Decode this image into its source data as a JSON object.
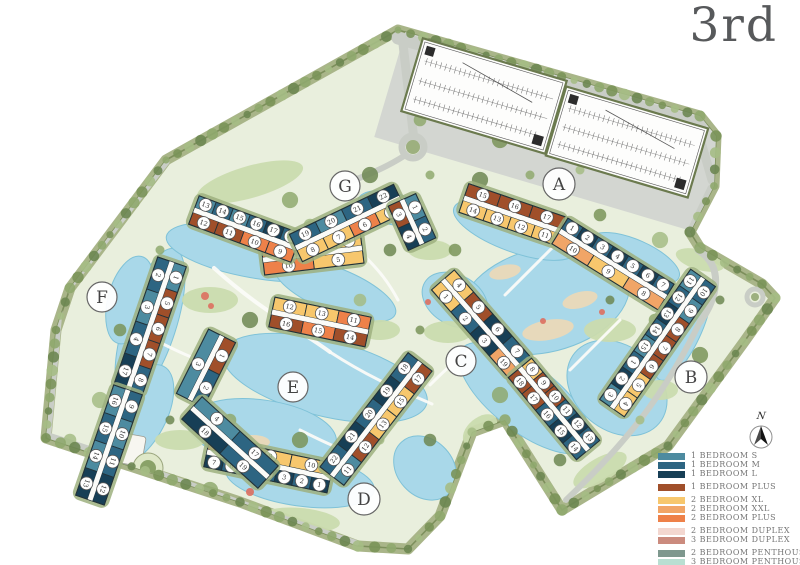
{
  "title": "3rd",
  "compass": {
    "north_label": "N"
  },
  "palette": {
    "s1": "#4d8ba0",
    "m1": "#2d6582",
    "l1": "#173f56",
    "p1": "#a04f2a",
    "xl2": "#f7c76d",
    "xxl2": "#f1a567",
    "p2": "#ee8149",
    "d2": "#f3d7d0",
    "d3": "#cb8b7e",
    "ph2": "#7e988e",
    "ph3": "#b9dfd2"
  },
  "legend": {
    "groups": [
      {
        "items": [
          {
            "label": "1 BEDROOM S",
            "color": "s1"
          },
          {
            "label": "1 BEDROOM M",
            "color": "m1"
          },
          {
            "label": "1 BEDROOM L",
            "color": "l1"
          }
        ]
      },
      {
        "items": [
          {
            "label": "1 BEDROOM PLUS",
            "color": "p1"
          }
        ]
      },
      {
        "items": [
          {
            "label": "2 BEDROOM XL",
            "color": "xl2"
          },
          {
            "label": "2 BEDROOM XXL",
            "color": "xxl2"
          },
          {
            "label": "2 BEDROOM PLUS",
            "color": "p2"
          }
        ]
      },
      {
        "items": [
          {
            "label": "2 BEDROOM DUPLEX",
            "color": "d2"
          },
          {
            "label": "3 BEDROOM DUPLEX",
            "color": "d3"
          }
        ]
      },
      {
        "items": [
          {
            "label": "2 BEDROOM PENTHOUSE",
            "color": "ph2"
          },
          {
            "label": "3 BEDROOM PENTHOUSE",
            "color": "ph3"
          }
        ]
      }
    ]
  },
  "buildings": [
    {
      "id": "A",
      "label": "A",
      "lx": 559,
      "ly": 184,
      "r": 16,
      "segments": [
        {
          "x1": 464,
          "y1": 198,
          "x2": 560,
          "y2": 231,
          "rows": [
            [
              {
                "n": 15,
                "c": "p1"
              },
              {
                "n": 16,
                "c": "p1"
              },
              {
                "n": 17,
                "c": "p1"
              }
            ],
            [
              {
                "n": 14,
                "c": "xl2"
              },
              {
                "n": 13,
                "c": "xl2"
              },
              {
                "n": 12,
                "c": "xl2"
              },
              {
                "n": 11,
                "c": "xl2"
              }
            ]
          ]
        },
        {
          "x1": 560,
          "y1": 231,
          "x2": 666,
          "y2": 297,
          "rows": [
            [
              {
                "n": 1,
                "c": "m1"
              },
              {
                "n": 2,
                "c": "l1"
              },
              {
                "n": 3,
                "c": "m1"
              },
              {
                "n": 4,
                "c": "l1"
              },
              {
                "n": 5,
                "c": "m1"
              },
              {
                "n": 6,
                "c": "l1"
              },
              {
                "n": 7,
                "c": "m1"
              }
            ],
            [
              {
                "n": 10,
                "c": "xxl2"
              },
              {
                "n": 9,
                "c": "xl2"
              },
              {
                "n": 8,
                "c": "xxl2"
              }
            ]
          ]
        }
      ]
    },
    {
      "id": "B",
      "label": "B",
      "lx": 691,
      "ly": 377,
      "r": 16,
      "segments": [
        {
          "x1": 703,
          "y1": 278,
          "x2": 612,
          "y2": 408,
          "rows": [
            [
              {
                "n": 10,
                "c": "m1"
              },
              {
                "n": 9,
                "c": "s1"
              },
              {
                "n": 8,
                "c": "p1"
              },
              {
                "n": 7,
                "c": "p1"
              },
              {
                "n": 6,
                "c": "p1"
              },
              {
                "n": 5,
                "c": "xl2"
              },
              {
                "n": 4,
                "c": "xl2"
              }
            ],
            [
              {
                "n": 11,
                "c": "s1"
              },
              {
                "n": 12,
                "c": "m1"
              },
              {
                "n": 13,
                "c": "l1"
              },
              {
                "n": 14,
                "c": "m1"
              },
              {
                "n": 15,
                "c": "s1"
              },
              {
                "n": 1,
                "c": "m1"
              },
              {
                "n": 2,
                "c": "l1"
              },
              {
                "n": 3,
                "c": "s1"
              }
            ]
          ]
        }
      ]
    },
    {
      "id": "C",
      "label": "C",
      "lx": 461,
      "ly": 361,
      "r": 15,
      "segments": [
        {
          "x1": 443,
          "y1": 280,
          "x2": 520,
          "y2": 368,
          "rows": [
            [
              {
                "n": 4,
                "c": "xl2"
              },
              {
                "n": 5,
                "c": "p1"
              },
              {
                "n": 6,
                "c": "l1"
              },
              {
                "n": 7,
                "c": "m1"
              }
            ],
            [
              {
                "n": 1,
                "c": "xl2"
              },
              {
                "n": 2,
                "c": "m1"
              },
              {
                "n": 3,
                "c": "l1"
              },
              {
                "n": 19,
                "c": "xxl2"
              }
            ]
          ]
        },
        {
          "x1": 520,
          "y1": 368,
          "x2": 588,
          "y2": 450,
          "rows": [
            [
              {
                "n": 8,
                "c": "xl2"
              },
              {
                "n": 9,
                "c": "p1"
              },
              {
                "n": 10,
                "c": "p1"
              },
              {
                "n": 11,
                "c": "m1"
              },
              {
                "n": 12,
                "c": "l1"
              },
              {
                "n": 13,
                "c": "m1"
              }
            ],
            [
              {
                "n": 18,
                "c": "p1"
              },
              {
                "n": 17,
                "c": "p1"
              },
              {
                "n": 16,
                "c": "m1"
              },
              {
                "n": 15,
                "c": "l1"
              },
              {
                "n": 14,
                "c": "m1"
              }
            ]
          ]
        }
      ]
    },
    {
      "id": "D",
      "label": "D",
      "lx": 364,
      "ly": 499,
      "r": 16,
      "segments": [
        {
          "x1": 207,
          "y1": 452,
          "x2": 330,
          "y2": 478,
          "rows": [
            [
              {
                "n": 8,
                "c": "p2"
              },
              {
                "n": 9,
                "c": "xl2"
              },
              {
                "n": 10,
                "c": "xl2"
              }
            ],
            [
              {
                "n": 7,
                "c": "l1"
              },
              {
                "n": 6,
                "c": "m1"
              },
              {
                "n": 5,
                "c": "l1"
              },
              {
                "n": 4,
                "c": "m1"
              },
              {
                "n": 3,
                "c": "l1"
              },
              {
                "n": 2,
                "c": "m1"
              },
              {
                "n": 1,
                "c": "l1"
              }
            ]
          ]
        },
        {
          "x1": 332,
          "y1": 476,
          "x2": 420,
          "y2": 362,
          "rows": [
            [
              {
                "n": 22,
                "c": "m1"
              },
              {
                "n": 21,
                "c": "l1"
              },
              {
                "n": 20,
                "c": "m1"
              },
              {
                "n": 19,
                "c": "l1"
              },
              {
                "n": 18,
                "c": "m1"
              }
            ],
            [
              {
                "n": 11,
                "c": "s1"
              },
              {
                "n": 12,
                "c": "p1"
              },
              {
                "n": 13,
                "c": "xl2"
              },
              {
                "n": 15,
                "c": "xl2"
              },
              {
                "n": 17,
                "c": "p1"
              }
            ]
          ]
        }
      ]
    },
    {
      "id": "E",
      "label": "E",
      "lx": 293,
      "ly": 387,
      "r": 15,
      "segments": [
        {
          "x1": 263,
          "y1": 260,
          "x2": 362,
          "y2": 248,
          "rows": [
            [
              {
                "n": 9,
                "c": "p2"
              },
              {
                "n": 8,
                "c": "p2"
              },
              {
                "n": 7,
                "c": "xxl2"
              },
              {
                "n": 6,
                "c": "xl2"
              }
            ],
            [
              {
                "n": 10,
                "c": "p2"
              },
              {
                "n": 5,
                "c": "xl2"
              }
            ]
          ]
        },
        {
          "x1": 272,
          "y1": 312,
          "x2": 368,
          "y2": 332,
          "rows": [
            [
              {
                "n": 12,
                "c": "xl2"
              },
              {
                "n": 13,
                "c": "xl2"
              },
              {
                "n": 11,
                "c": "p2"
              }
            ],
            [
              {
                "n": 16,
                "c": "p1"
              },
              {
                "n": 15,
                "c": "p2"
              },
              {
                "n": 14,
                "c": "p1"
              }
            ]
          ]
        },
        {
          "x1": 222,
          "y1": 336,
          "x2": 190,
          "y2": 400,
          "rows": [
            [
              {
                "n": 1,
                "c": "p1"
              },
              {
                "n": 2,
                "c": "m1"
              }
            ],
            [
              {
                "n": 3,
                "c": "s1"
              }
            ]
          ]
        },
        {
          "x1": 192,
          "y1": 408,
          "x2": 268,
          "y2": 477,
          "rows": [
            [
              {
                "n": 4,
                "c": "s1"
              },
              {
                "n": 17,
                "c": "m1"
              }
            ],
            [
              {
                "n": 18,
                "c": "l1"
              },
              {
                "n": 19,
                "c": "m1"
              }
            ]
          ]
        }
      ]
    },
    {
      "id": "F",
      "label": "F",
      "lx": 102,
      "ly": 297,
      "r": 15,
      "segments": [
        {
          "x1": 172,
          "y1": 262,
          "x2": 128,
          "y2": 390,
          "rows": [
            [
              {
                "n": 1,
                "c": "s1"
              },
              {
                "n": 5,
                "c": "p1"
              },
              {
                "n": 6,
                "c": "p1"
              },
              {
                "n": 7,
                "c": "p1"
              },
              {
                "n": 8,
                "c": "m1"
              }
            ],
            [
              {
                "n": 2,
                "c": "m1"
              },
              {
                "n": 3,
                "c": "s1"
              },
              {
                "n": 4,
                "c": "m1"
              },
              {
                "n": 17,
                "c": "l1"
              }
            ]
          ]
        },
        {
          "x1": 128,
          "y1": 390,
          "x2": 90,
          "y2": 500,
          "rows": [
            [
              {
                "n": 9,
                "c": "m1"
              },
              {
                "n": 10,
                "c": "s1"
              },
              {
                "n": 11,
                "c": "m1"
              },
              {
                "n": 12,
                "c": "l1"
              }
            ],
            [
              {
                "n": 16,
                "c": "s1"
              },
              {
                "n": 15,
                "c": "m1"
              },
              {
                "n": 14,
                "c": "s1"
              },
              {
                "n": 13,
                "c": "l1"
              }
            ]
          ]
        }
      ]
    },
    {
      "id": "G",
      "label": "G",
      "lx": 345,
      "ly": 186,
      "r": 15,
      "segments": [
        {
          "x1": 194,
          "y1": 210,
          "x2": 296,
          "y2": 248,
          "rows": [
            [
              {
                "n": 13,
                "c": "s1"
              },
              {
                "n": 14,
                "c": "m1"
              },
              {
                "n": 15,
                "c": "s1"
              },
              {
                "n": 16,
                "c": "m1"
              },
              {
                "n": 17,
                "c": "l1"
              },
              {
                "n": 18,
                "c": "m1"
              }
            ],
            [
              {
                "n": 12,
                "c": "p1"
              },
              {
                "n": 11,
                "c": "p1"
              },
              {
                "n": 10,
                "c": "p2"
              },
              {
                "n": 9,
                "c": "p2"
              }
            ]
          ]
        },
        {
          "x1": 296,
          "y1": 248,
          "x2": 400,
          "y2": 198,
          "rows": [
            [
              {
                "n": 19,
                "c": "m1"
              },
              {
                "n": 20,
                "c": "s1"
              },
              {
                "n": 21,
                "c": "m1"
              },
              {
                "n": 22,
                "c": "l1"
              }
            ],
            [
              {
                "n": 8,
                "c": "xl2"
              },
              {
                "n": 7,
                "c": "xl2"
              },
              {
                "n": 6,
                "c": "p2"
              },
              {
                "n": 5,
                "c": "xl2"
              }
            ]
          ]
        },
        {
          "x1": 402,
          "y1": 200,
          "x2": 422,
          "y2": 244,
          "rows": [
            [
              {
                "n": 1,
                "c": "s1"
              },
              {
                "n": 2,
                "c": "m1"
              }
            ],
            [
              {
                "n": 3,
                "c": "p1"
              },
              {
                "n": 4,
                "c": "l1"
              }
            ]
          ]
        }
      ]
    }
  ]
}
